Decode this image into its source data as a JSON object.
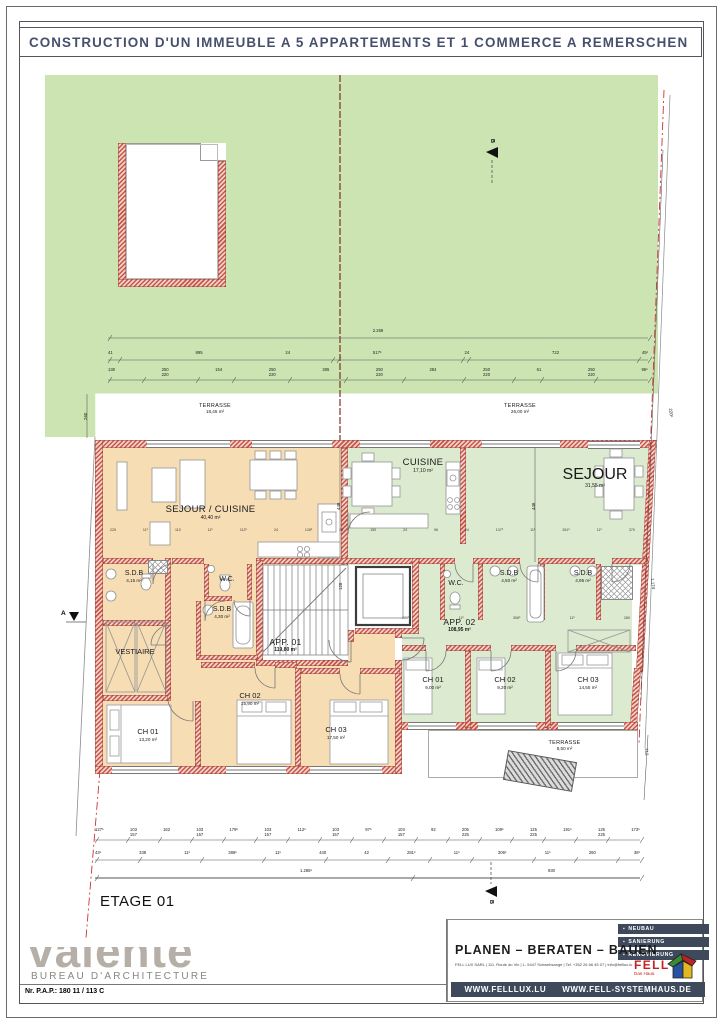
{
  "title": "CONSTRUCTION D'UN IMMEUBLE A 5 APPARTEMENTS ET 1 COMMERCE A REMERSCHEN",
  "floor_label": "ETAGE 01",
  "markers": {
    "a": "A",
    "b": "B"
  },
  "plan": {
    "terrace_top_left": {
      "name": "TERRASSE",
      "area": "18,45 m²"
    },
    "terrace_top_right": {
      "name": "TERRASSE",
      "area": "26,00 m²"
    },
    "terrace_bottom": {
      "name": "TERRASSE",
      "area": "8,50 m²"
    },
    "app1": {
      "label": "APP. 01",
      "area": "119,80 m²",
      "sejour_cuisine": {
        "name": "SEJOUR / CUISINE",
        "area": "40,40 m²"
      },
      "sdb1": {
        "name": "S.D.B",
        "area": "4,15 m²"
      },
      "wc": {
        "name": "W.C."
      },
      "sdb2": {
        "name": "S.D.B",
        "area": "4,30 m²"
      },
      "vestiaire": {
        "name": "VESTIAIRE"
      },
      "ch1": {
        "name": "CH 01",
        "area": "13,20 m²"
      },
      "ch2": {
        "name": "CH 02",
        "area": "15,90 m²"
      },
      "ch3": {
        "name": "CH 03",
        "area": "17,50 m²"
      }
    },
    "app2": {
      "label": "APP. 02",
      "area": "108,95 m²",
      "cuisine": {
        "name": "CUISINE",
        "area": "17,10 m²"
      },
      "sejour": {
        "name": "SEJOUR",
        "area": "31,55 m²"
      },
      "wc": {
        "name": "W.C."
      },
      "sdb1": {
        "name": "S.D.B",
        "area": "4,50 m²"
      },
      "sdb2": {
        "name": "S.D.B",
        "area": "4,95 m²"
      },
      "ch1": {
        "name": "CH 01",
        "area": "9,00 m²"
      },
      "ch2": {
        "name": "CH 02",
        "area": "9,20 m²"
      },
      "ch3": {
        "name": "CH 03",
        "area": "14,55 m²"
      }
    },
    "dims": {
      "top_total": "2.269",
      "top_row2": [
        "41",
        "895",
        "24",
        "517⁵",
        "24",
        "722",
        "45²"
      ],
      "top_row3": [
        "138",
        "250\n220",
        "154",
        "250\n220",
        "285",
        "250\n220",
        "284",
        "250\n220",
        "61",
        "250\n220",
        "96⁵"
      ],
      "bottom_row1": [
        "127⁵",
        "103\n157",
        "162",
        "103\n157",
        "179⁵",
        "103\n157",
        "112⁵",
        "103\n157",
        "97⁵",
        "103\n157",
        "92",
        "205\n225",
        "109⁵",
        "125\n225",
        "191⁵",
        "125\n225",
        "173⁵"
      ],
      "bottom_row2": [
        "43¹",
        "338",
        "11⁵",
        "388⁵",
        "11⁵",
        "440",
        "42",
        "281⁵",
        "11⁵",
        "306⁵",
        "11⁵",
        "260",
        "38¹"
      ],
      "bottom_row3": [
        "1.285⁵",
        "930"
      ],
      "interior_row1": [
        "225",
        "11⁵",
        "110",
        "11⁵",
        "112⁵",
        "24",
        "128⁵",
        "24",
        "150",
        "24",
        "96",
        "24",
        "137⁵",
        "11⁵",
        "261⁵",
        "11⁵",
        "370"
      ],
      "interior_row2": [
        "289⁵",
        "11⁵",
        "306⁵",
        "11⁵",
        "260"
      ],
      "v448a": "448",
      "v448b": "448",
      "v260": "260",
      "v220": "220⁵",
      "v1174": "1.174",
      "v212": "212",
      "v128": "128"
    }
  },
  "footer": {
    "architect": {
      "logo": "valente",
      "subtitle": "BUREAU D'ARCHITECTURE",
      "ref": "Nr. P.A.P.: 180  11 / 113 C"
    },
    "company": {
      "badges": [
        "NEUBAU",
        "SANIERUNG",
        "RENOVIERUNG"
      ],
      "slogan": "PLANEN – BERATEN – BAUEN",
      "info": "FELL LUX SARL | 111, Route du Vin | L- 5447 Schwebsange | Tel. +352 26 66 45 07  |  info@felllux.lu",
      "brand": "FELL",
      "brand_sub": "Das Haus.",
      "websites": [
        "WWW.FELLLUX.LU",
        "WWW.FELL-SYSTEMHAUS.DE"
      ]
    }
  }
}
